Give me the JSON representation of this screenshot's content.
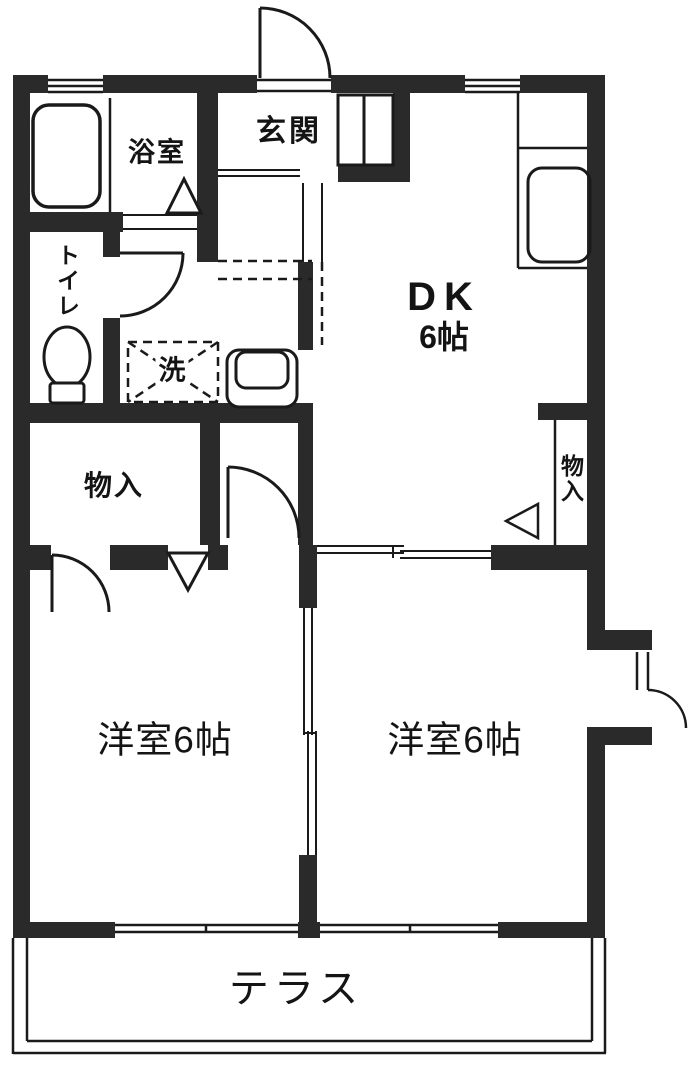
{
  "floor_plan": {
    "type": "apartment-floor-plan",
    "labels": {
      "entrance": "玄関",
      "bathroom": "浴室",
      "toilet": "トイレ",
      "washer": "洗",
      "closet_left": "物入",
      "closet_right": "物入",
      "dk_name": "DK",
      "dk_size": "6帖",
      "bedroom_left": "洋室6帖",
      "bedroom_right": "洋室6帖",
      "terrace": "テラス"
    },
    "colors": {
      "wall": "#2a2a2a",
      "line": "#1a1a1a",
      "background": "#ffffff"
    }
  }
}
